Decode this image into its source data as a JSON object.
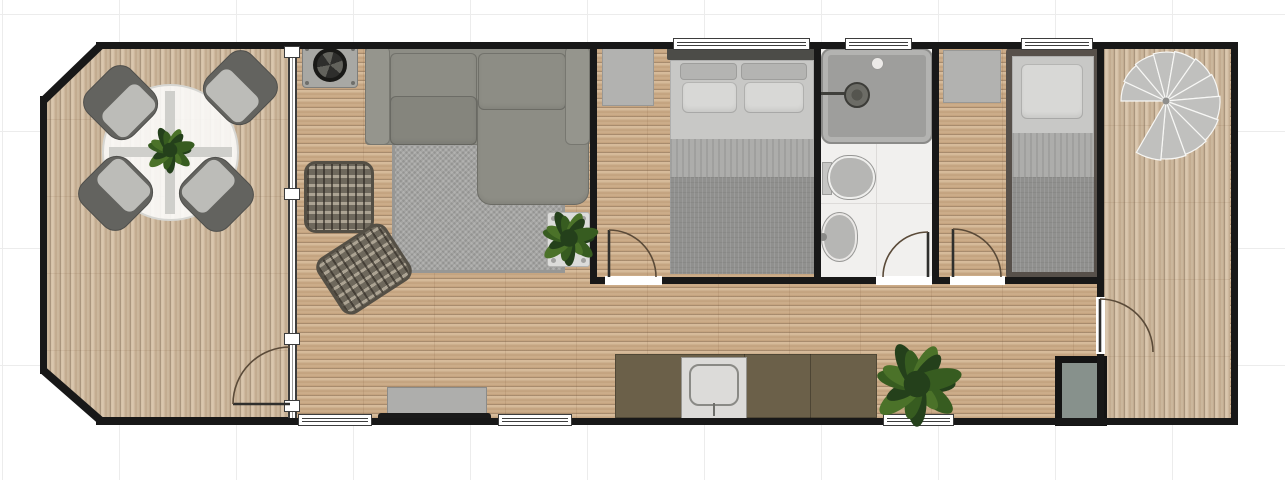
{
  "plan": {
    "type": "floor-plan",
    "description": "Top-view architectural floor plan of an elongated cabin / houseboat with front deck",
    "rooms": [
      {
        "name": "deck-terrace",
        "features": [
          "round-dining-table",
          "dining-chair x4",
          "potted-plant",
          "glass-facade",
          "glass-door"
        ]
      },
      {
        "name": "living-room",
        "features": [
          "corner-sofa-with-chaise",
          "area-rug",
          "wood-stove",
          "wicker-pouf x2",
          "plant-on-stand"
        ]
      },
      {
        "name": "bedroom-double",
        "features": [
          "double-bed",
          "pillows x4",
          "wardrobe",
          "door",
          "window"
        ]
      },
      {
        "name": "bathroom",
        "features": [
          "shower",
          "toilet",
          "washbasin",
          "door",
          "window"
        ]
      },
      {
        "name": "bedroom-single",
        "features": [
          "single-bed",
          "pillow",
          "wardrobe",
          "door",
          "window"
        ]
      },
      {
        "name": "stair-room",
        "features": [
          "spiral-staircase",
          "door"
        ]
      },
      {
        "name": "kitchen-corridor",
        "features": [
          "kitchen-counter",
          "kitchen-sink",
          "tv-sideboard",
          "large-plant",
          "utility-box"
        ]
      }
    ],
    "counts": {
      "doors": 5,
      "windows": 6,
      "plants": 3,
      "chairs": 4,
      "beds": 2
    }
  },
  "colors": {
    "wall": "#181818",
    "grid_line": "#ececec",
    "wood_light": "#d9bf9f",
    "wood_mid": "#cfb08d",
    "wood_dark": "#c1a07c",
    "deck_light": "#dcc9b0",
    "deck_mid": "#cfbca2",
    "deck_dark": "#bfa78b",
    "sofa": "#8d8d85",
    "sofa_dark": "#85857d",
    "rug": "#a5a5a3",
    "wicker": "#6e685c",
    "counter": "#6b6049",
    "sink": "#dcdbd9",
    "tile": "#f1f0ee",
    "shower": "#9e9e9c",
    "fixture": "#b6b6b4",
    "bed_sheet": "#c8c8c6",
    "bed_band": "#adadab",
    "bed_blanket": "#90908e",
    "headboard": "#4c4c48",
    "bedframe": "#57504a",
    "wardrobe": "#b2b2b0",
    "pillow": "#d8d8d6",
    "stair_step": "#c0c0be",
    "tv": "#aeaeac",
    "tv_bar": "#1a1a1a",
    "utility": "#87918c",
    "plant_dark": "#24401b",
    "plant_mid": "#375c20",
    "plant_light": "#4b7229",
    "chair": "#63635f",
    "chair_cushion": "#bcbcb8",
    "table_top": "#fbfbf9",
    "stove_plate": "#a8a8a4",
    "door_arc": "#5a4a38"
  }
}
